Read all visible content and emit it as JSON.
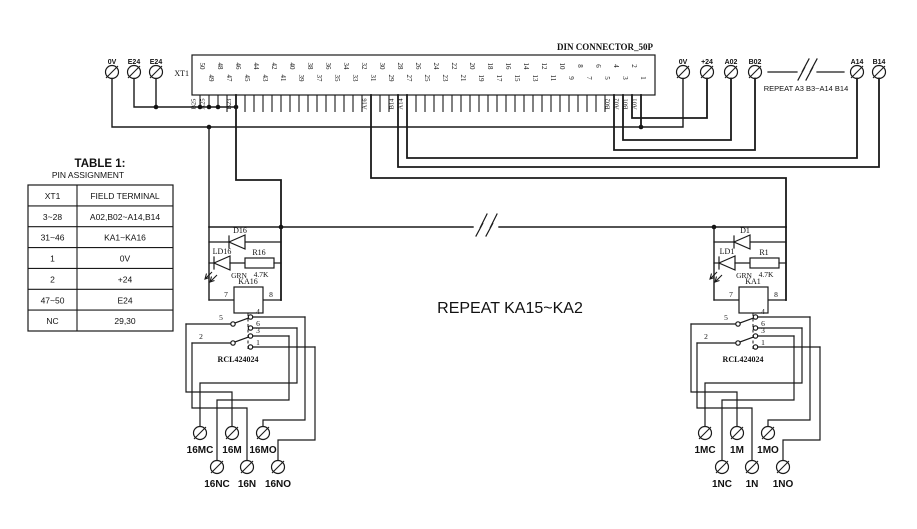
{
  "diagram": {
    "colors": {
      "line": "#1a1a1a",
      "background": "#ffffff"
    },
    "connector": {
      "name_label": "XT1",
      "title": "DIN CONNECTOR_50P",
      "pins_top": [
        "50",
        "48",
        "46",
        "44",
        "42",
        "40",
        "38",
        "36",
        "34",
        "32",
        "30",
        "28",
        "26",
        "24",
        "22",
        "20",
        "18",
        "16",
        "14",
        "12",
        "10",
        "8",
        "6",
        "4",
        "2"
      ],
      "pins_bottom": [
        "49",
        "47",
        "45",
        "43",
        "41",
        "39",
        "37",
        "35",
        "33",
        "31",
        "29",
        "27",
        "25",
        "23",
        "21",
        "19",
        "17",
        "15",
        "13",
        "11",
        "9",
        "7",
        "5",
        "3",
        "1"
      ],
      "wire_labels": [
        "B25",
        "A25",
        "B23",
        "A16",
        "B14",
        "A14",
        "B02",
        "A02",
        "B01",
        "A01"
      ]
    },
    "left_terminals": [
      "0V",
      "E24",
      "E24"
    ],
    "right_terminals": [
      "0V",
      "+24",
      "A02",
      "B02"
    ],
    "far_right_terminals": [
      "A14",
      "B14"
    ],
    "right_break_label": "REPEAT A3 B3~A14 B14",
    "center_note": "REPEAT KA15~KA2",
    "table": {
      "title": "TABLE 1:",
      "subtitle": "PIN ASSIGNMENT",
      "headers": [
        "XT1",
        "FIELD TERMINAL"
      ],
      "rows": [
        [
          "3~28",
          "A02,B02~A14,B14"
        ],
        [
          "31~46",
          "KA1~KA16"
        ],
        [
          "1",
          "0V"
        ],
        [
          "2",
          "+24"
        ],
        [
          "47~50",
          "E24"
        ],
        [
          "NC",
          "29,30"
        ]
      ]
    },
    "units": [
      {
        "diode": "D16",
        "led": "LD16",
        "led_color": "GRN",
        "resistor": "R16",
        "resistor_value": "4.7K",
        "coil": "KA16",
        "coil_pin_left": "7",
        "coil_pin_right": "8",
        "part_number": "RCL424024",
        "pins": {
          "p5": "5",
          "p4": "4",
          "p6": "6",
          "p2": "2",
          "p3": "3",
          "p1": "1"
        },
        "terminals_m": [
          "16MC",
          "16M",
          "16MO"
        ],
        "terminals_n": [
          "16NC",
          "16N",
          "16NO"
        ]
      },
      {
        "diode": "D1",
        "led": "LD1",
        "led_color": "GRN",
        "resistor": "R1",
        "resistor_value": "4.7K",
        "coil": "KA1",
        "coil_pin_left": "7",
        "coil_pin_right": "8",
        "part_number": "RCL424024",
        "pins": {
          "p5": "5",
          "p4": "4",
          "p6": "6",
          "p2": "2",
          "p3": "3",
          "p1": "1"
        },
        "terminals_m": [
          "1MC",
          "1M",
          "1MO"
        ],
        "terminals_n": [
          "1NC",
          "1N",
          "1NO"
        ]
      }
    ]
  }
}
